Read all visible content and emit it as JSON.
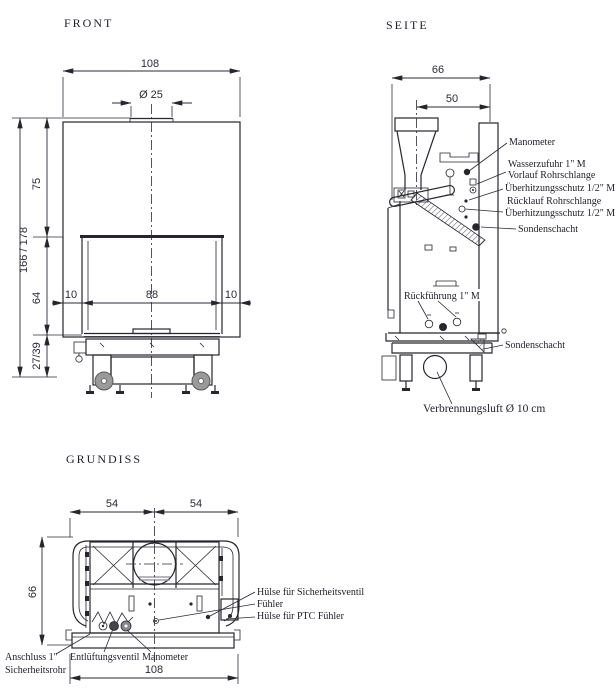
{
  "front": {
    "title": "FRONT",
    "dim_width": "108",
    "dim_stub": "Ø 25",
    "dim_upper": "75",
    "dim_door": "64",
    "dim_base": "27/39",
    "dim_total": "166 / 178",
    "dim_left_gap": "10",
    "dim_glass": "88",
    "dim_right_gap": "10"
  },
  "seite": {
    "title": "SEITE",
    "dim_depth": "66",
    "dim_body": "50",
    "manometer": "Manometer",
    "wasserzufuhr": "Wasserzufuhr 1\" M",
    "vorlauf": "Vorlauf Rohrschlange",
    "ueberhitz1": "Überhitzungsschutz 1/2\" M",
    "ruecklauf": "Rücklauf Rohrschlange",
    "ueberhitz2": "Überhitzungsschutz 1/2\" M",
    "sonden1": "Sondenschacht",
    "rueckfuehrung": "Rückführung 1\" M",
    "sonden2": "Sondenschacht",
    "verbrennungsluft": "Verbrennungsluft Ø 10 cm"
  },
  "grundiss": {
    "title": "GRUNDISS",
    "dim_left_half": "54",
    "dim_right_half": "54",
    "dim_depth": "66",
    "dim_width": "108",
    "huelse_sv": "Hülse für Sicherheitsventil",
    "fuehler": "Fühler",
    "huelse_ptc": "Hülse für PTC Fühler",
    "anschluss": "Anschluss 1\"",
    "sicherheitsrohr": "Sicherheitsrohr",
    "entlueftung": "Entlüftungsventil",
    "manometer": "Manometer"
  }
}
